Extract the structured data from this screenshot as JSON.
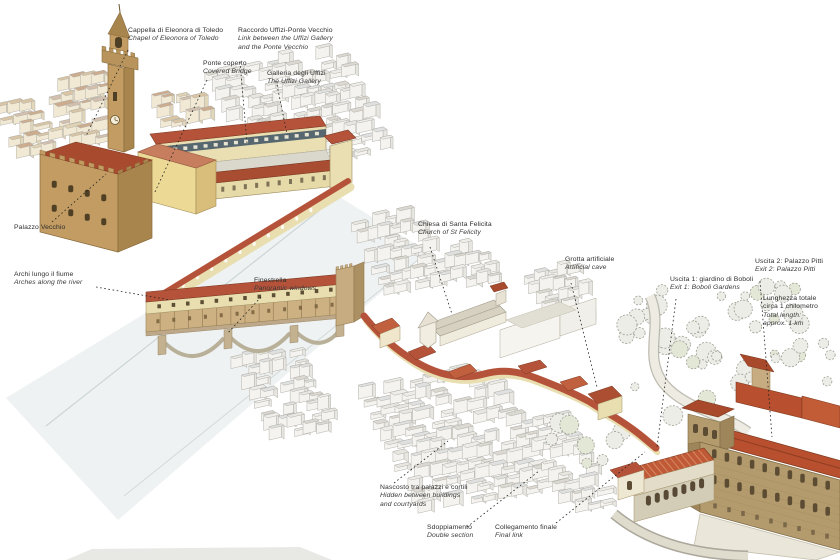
{
  "labels": {
    "cappella": {
      "l1": "Cappella di Eleonora di Toledo",
      "l2": "Chapel of Eleonora of Toledo"
    },
    "raccordo": {
      "l1": "Raccordo Uffizi-Ponte Vecchio",
      "l2": "Link between the Uffizi Gallery",
      "l3": "and the Ponte Vecchio"
    },
    "ponte_coperto": {
      "l1": "Ponte coperto",
      "l2": "Covered Bridge"
    },
    "galleria": {
      "l1": "Galleria degli Uffizi",
      "l2": "The Uffizi Gallery"
    },
    "palazzo_vecchio": {
      "l1": "Palazzo Vecchio"
    },
    "archi": {
      "l1": "Archi lungo il fiume",
      "l2": "Arches along the river"
    },
    "finestrella": {
      "l1": "Finestrella",
      "l2": "Panoramic windows"
    },
    "chiesa": {
      "l1": "Chiesa di Santa Felicita",
      "l2": "Church of St Felicity"
    },
    "grotta": {
      "l1": "Grotta artificiale",
      "l2": "Artificial cave"
    },
    "uscita1": {
      "l1": "Uscita 1: giardino di Boboli",
      "l2": "Exit 1: Boboli Gardens"
    },
    "uscita2": {
      "l1": "Uscita 2: Palazzo Pitti",
      "l2": "Exit 2: Palazzo Pitti"
    },
    "lunghezza": {
      "l1": "Lunghezza totale",
      "l2": "circa 1 chilometro",
      "l3": "Total length:",
      "l4": "approx. 1 km"
    },
    "nascosto": {
      "l1": "Nascosto tra palazzi e cortili",
      "l2": "Hidden between buildings",
      "l3": "and courtyards"
    },
    "sdoppiamento": {
      "l1": "Sdoppiamento",
      "l2": "Double section"
    },
    "collegamento": {
      "l1": "Collegamento finale",
      "l2": "Final link"
    }
  },
  "colors": {
    "corridor_roof": "#b5533a",
    "corridor_wall": "#e8deb0",
    "palazzo_stone": "#c29c62",
    "pitti_stone": "#b49b6d",
    "roof_red": "#b84f2e",
    "sketch_grey": "#e7e6e1",
    "river": "#eff2f2",
    "label_text": "#2e2e2e",
    "leader_line": "#222222"
  }
}
